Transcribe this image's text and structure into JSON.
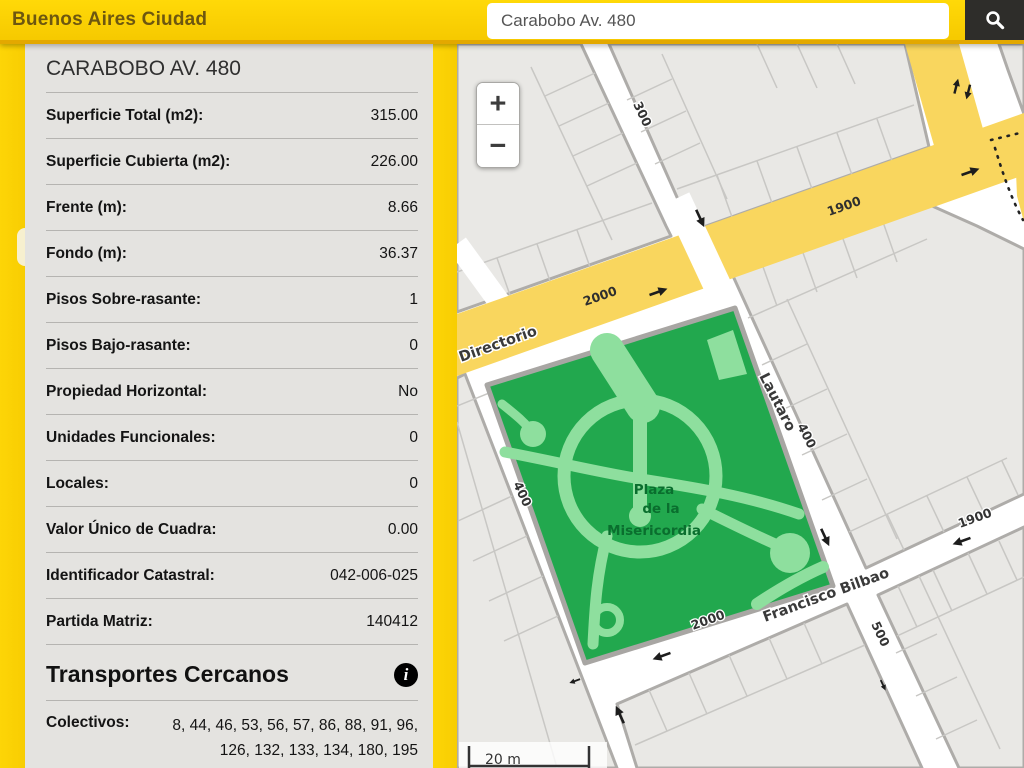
{
  "header": {
    "brand": "Buenos Aires Ciudad",
    "search_value": "Carabobo Av. 480",
    "search_icon": "magnifier"
  },
  "panel": {
    "title": "CARABOBO AV. 480",
    "rows": [
      {
        "label": "Superficie Total (m2):",
        "value": "315.00"
      },
      {
        "label": "Superficie Cubierta (m2):",
        "value": "226.00"
      },
      {
        "label": "Frente (m):",
        "value": "8.66"
      },
      {
        "label": "Fondo (m):",
        "value": "36.37"
      },
      {
        "label": "Pisos Sobre-rasante:",
        "value": "1"
      },
      {
        "label": "Pisos Bajo-rasante:",
        "value": "0"
      },
      {
        "label": "Propiedad Horizontal:",
        "value": "No"
      },
      {
        "label": "Unidades Funcionales:",
        "value": "0"
      },
      {
        "label": "Locales:",
        "value": "0"
      },
      {
        "label": "Valor Único de Cuadra:",
        "value": "0.00"
      },
      {
        "label": "Identificador Catastral:",
        "value": "042-006-025"
      },
      {
        "label": "Partida Matriz:",
        "value": "140412"
      }
    ],
    "transport": {
      "heading": "Transportes Cercanos",
      "info_icon": "i",
      "colectivos_label": "Colectivos:",
      "colectivos_value": "8, 44, 46, 53, 56, 57, 86, 88, 91, 96, 126, 132, 133, 134, 180, 195"
    }
  },
  "map": {
    "zoom_in": "+",
    "zoom_out": "−",
    "scale_label": "20 m",
    "labels": {
      "directorio": "Directorio",
      "lautaro": "Lautaro",
      "bilbao": "Francisco Bilbao",
      "plaza_line1": "Plaza",
      "plaza_line2": "de la",
      "plaza_line3": "Misericordia",
      "n300": "300",
      "n400_west": "400",
      "n400_lautaro": "400",
      "n500": "500",
      "n1900_av": "1900",
      "n1900_bilbao": "1900",
      "n2000_av": "2000",
      "n2000_bilbao": "2000"
    },
    "colors": {
      "avenue_yellow": "#f9d65e",
      "block_gray": "#e9e8e5",
      "plaza_green": "#22a84e",
      "plaza_path_green": "#8edf9e"
    }
  }
}
